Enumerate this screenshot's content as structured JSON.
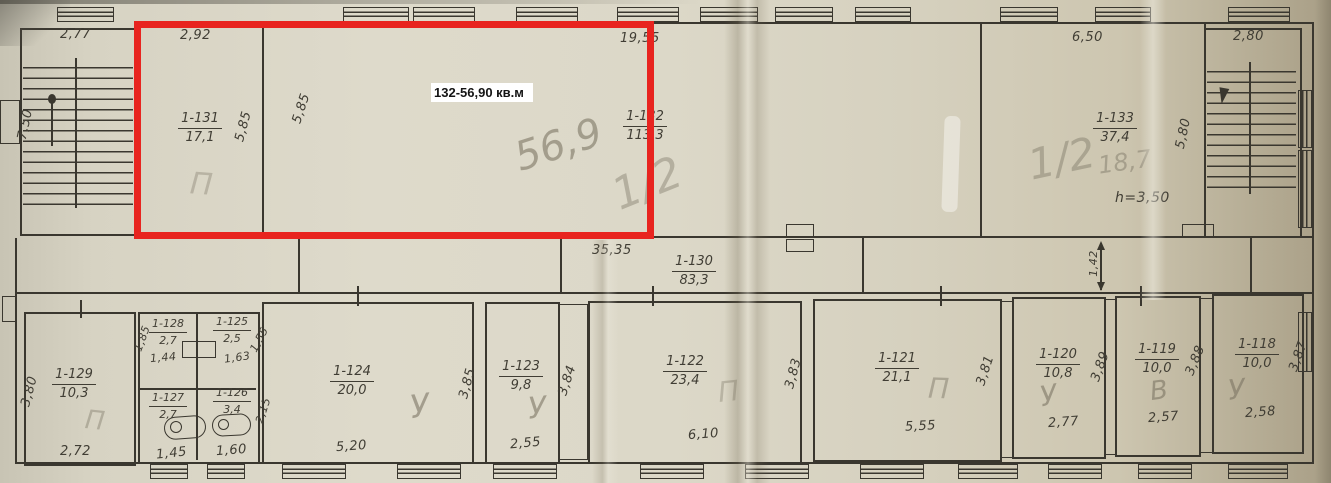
{
  "overlay": {
    "area_label": "132-56,90 кв.м"
  },
  "rooms": {
    "r131": {
      "num": "1-131",
      "area": "17,1"
    },
    "r132": {
      "num": "1-132",
      "area": "113,3"
    },
    "r133": {
      "num": "1-133",
      "area": "37,4"
    },
    "r130": {
      "num": "1-130",
      "area": "83,3"
    },
    "r129": {
      "num": "1-129",
      "area": "10,3"
    },
    "r128": {
      "num": "1-128",
      "area": "2,7"
    },
    "r127": {
      "num": "1-127",
      "area": "2,7"
    },
    "r126": {
      "num": "1-126",
      "area": "3,4"
    },
    "r125": {
      "num": "1-125",
      "area": "2,5"
    },
    "r124": {
      "num": "1-124",
      "area": "20,0"
    },
    "r123": {
      "num": "1-123",
      "area": "9,8"
    },
    "r122": {
      "num": "1-122",
      "area": "23,4"
    },
    "r121": {
      "num": "1-121",
      "area": "21,1"
    },
    "r120": {
      "num": "1-120",
      "area": "10,8"
    },
    "r119": {
      "num": "1-119",
      "area": "10,0"
    },
    "r118": {
      "num": "1-118",
      "area": "10,0"
    }
  },
  "dims": {
    "stair_left_top": "2,77",
    "stair_left_height": "7,50",
    "r131_top": "2,92",
    "r132_top": "19,55",
    "r133_top": "6,50",
    "stair_right_top": "2,80",
    "r131_side": "5,85",
    "r132_side": "5,85",
    "r133_side": "5,80",
    "ceiling_height": "h=3,50",
    "corridor_width": "1,42",
    "corridor_length": "35,35",
    "r129_side": "3,80",
    "r129_bottom": "2,72",
    "r128_side": "1,85",
    "r128_bottom": "1,44",
    "r125_side": "1,55",
    "r125_bottom": "1,63",
    "r126_side": "2,15",
    "r127_bottom": "1,45",
    "r126_bottom": "1,60",
    "r124_bottom": "5,20",
    "r124_side": "3,85",
    "r123_bottom": "2,55",
    "r123_side": "3,84",
    "r122_bottom": "6,10",
    "r122_side": "3,83",
    "r121_bottom": "5,55",
    "r121_side": "3,81",
    "r120_bottom": "2,77",
    "r120_side": "3,89",
    "r119_bottom": "2,57",
    "r119_side": "3,88",
    "r118_bottom": "2,58",
    "r118_side": "3,87"
  },
  "pencil": {
    "r132_area": "56,9",
    "r132_floor": "1/2",
    "r133_floor": "1/2",
    "r133_area": "18,7",
    "r131_mark": "П",
    "r129_mark": "П",
    "r124_mark": "У",
    "r123_mark": "У",
    "r122_mark": "П",
    "r121_mark": "П",
    "r120_mark": "У",
    "r119_mark": "В",
    "r118_mark": "У"
  }
}
